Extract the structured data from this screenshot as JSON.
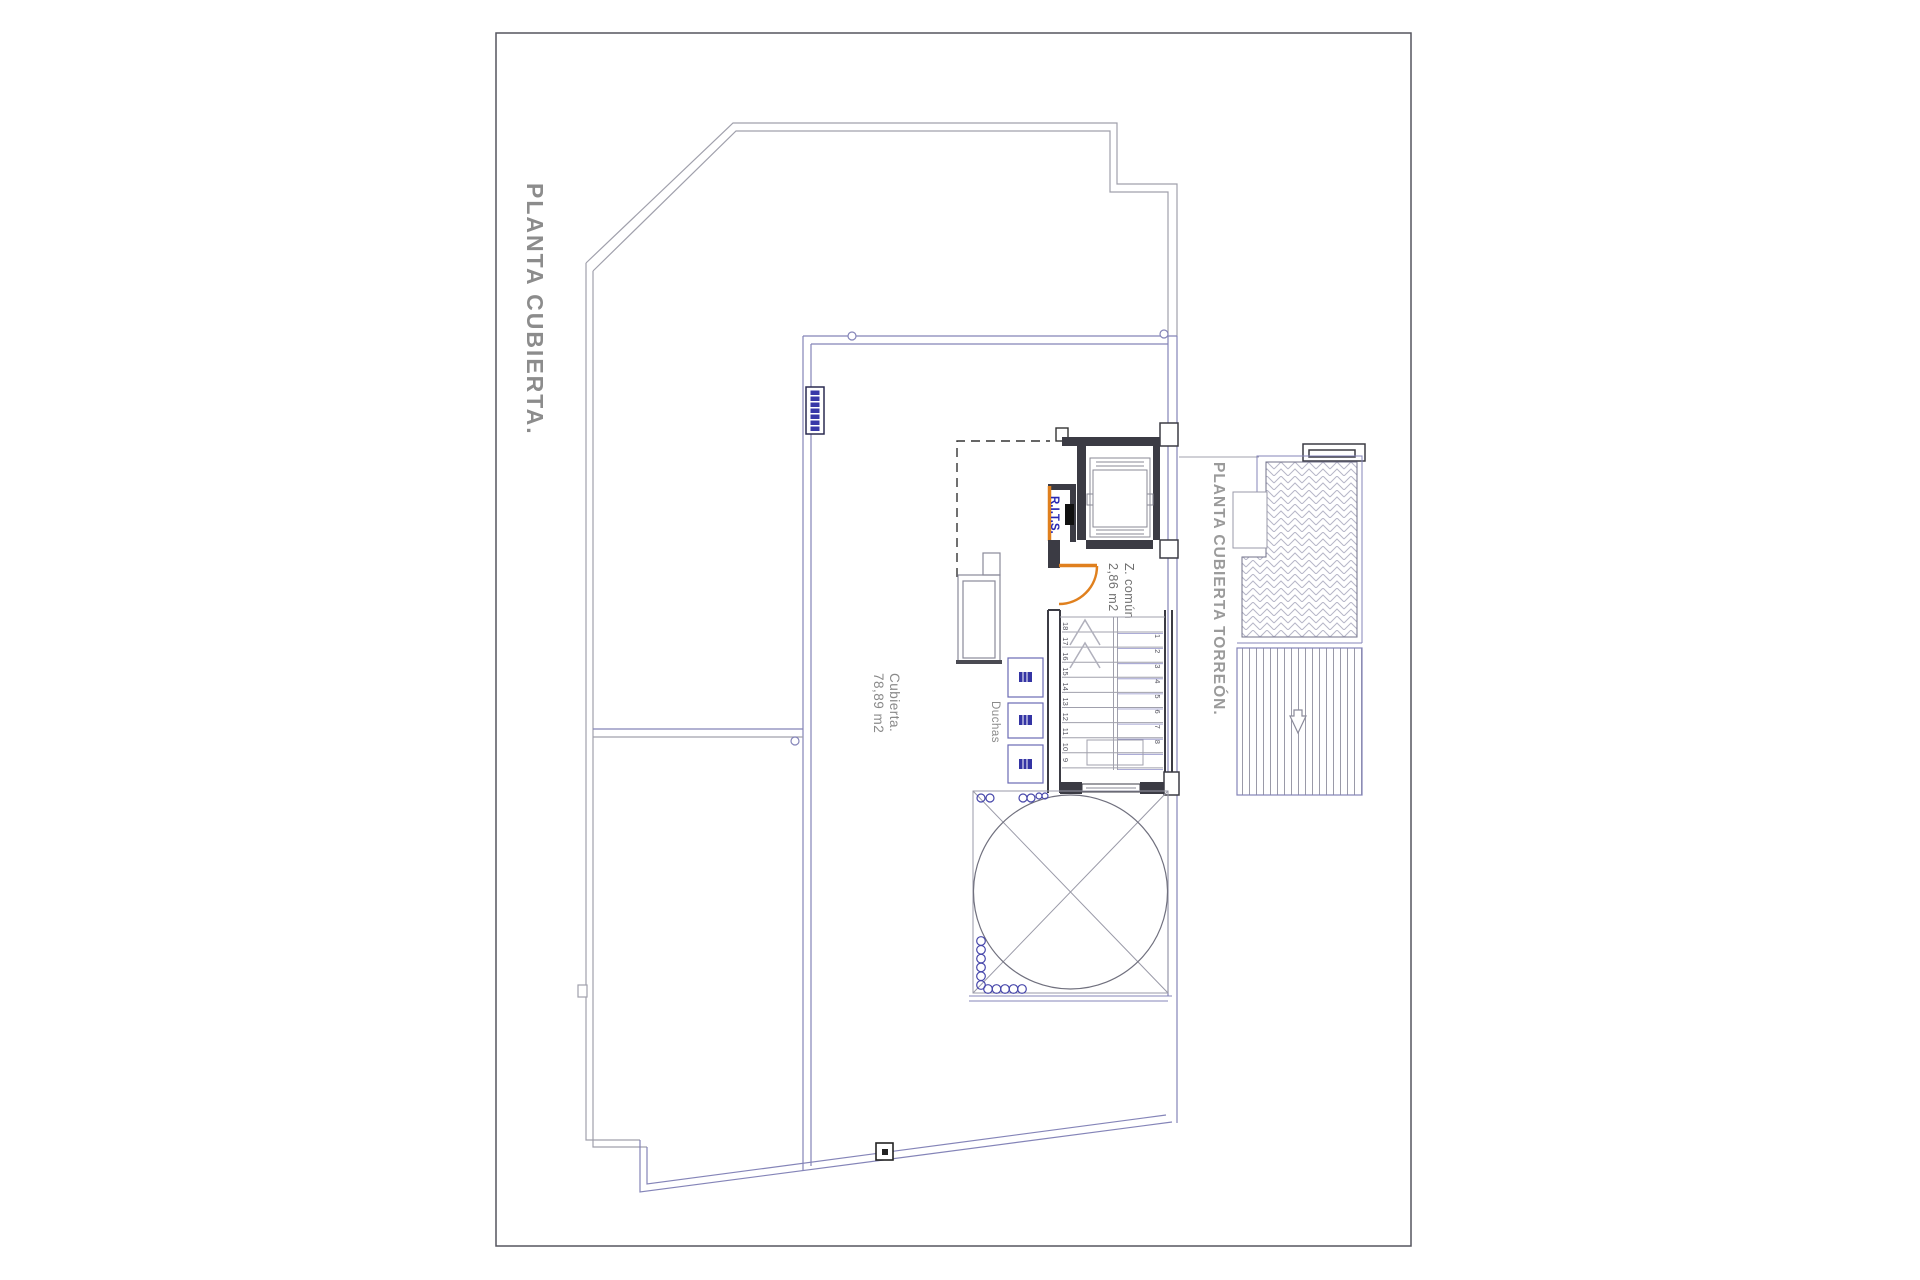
{
  "sheet": {
    "title": "PLANTA CUBIERTA.",
    "torreon_title": "PLANTA CUBIERTA TORREÓN."
  },
  "labels": {
    "roof_area_name": "Cubierta.",
    "roof_area_size": "78,89 m2",
    "showers": "Duchas",
    "common_zone_name": "Z. común",
    "common_zone_size": "2,86 m2",
    "rits": "R.I.T.S."
  },
  "stairs": {
    "left_numbers": [
      "18",
      "17",
      "16",
      "15",
      "14",
      "13",
      "12",
      "11",
      "10",
      "9"
    ],
    "right_numbers": [
      "1",
      "2",
      "3",
      "4",
      "5",
      "6",
      "7",
      "8"
    ]
  },
  "colors": {
    "outline_gray": "#a0a0ac",
    "outline_blue": "#8484b8",
    "wall_dark": "#3b3b44",
    "accent_orange": "#e0801e",
    "title_gray": "#8c8c8c",
    "text_gray": "#8a8a8a",
    "text_blue": "#2828b4",
    "icon_navy": "#3434a4"
  }
}
